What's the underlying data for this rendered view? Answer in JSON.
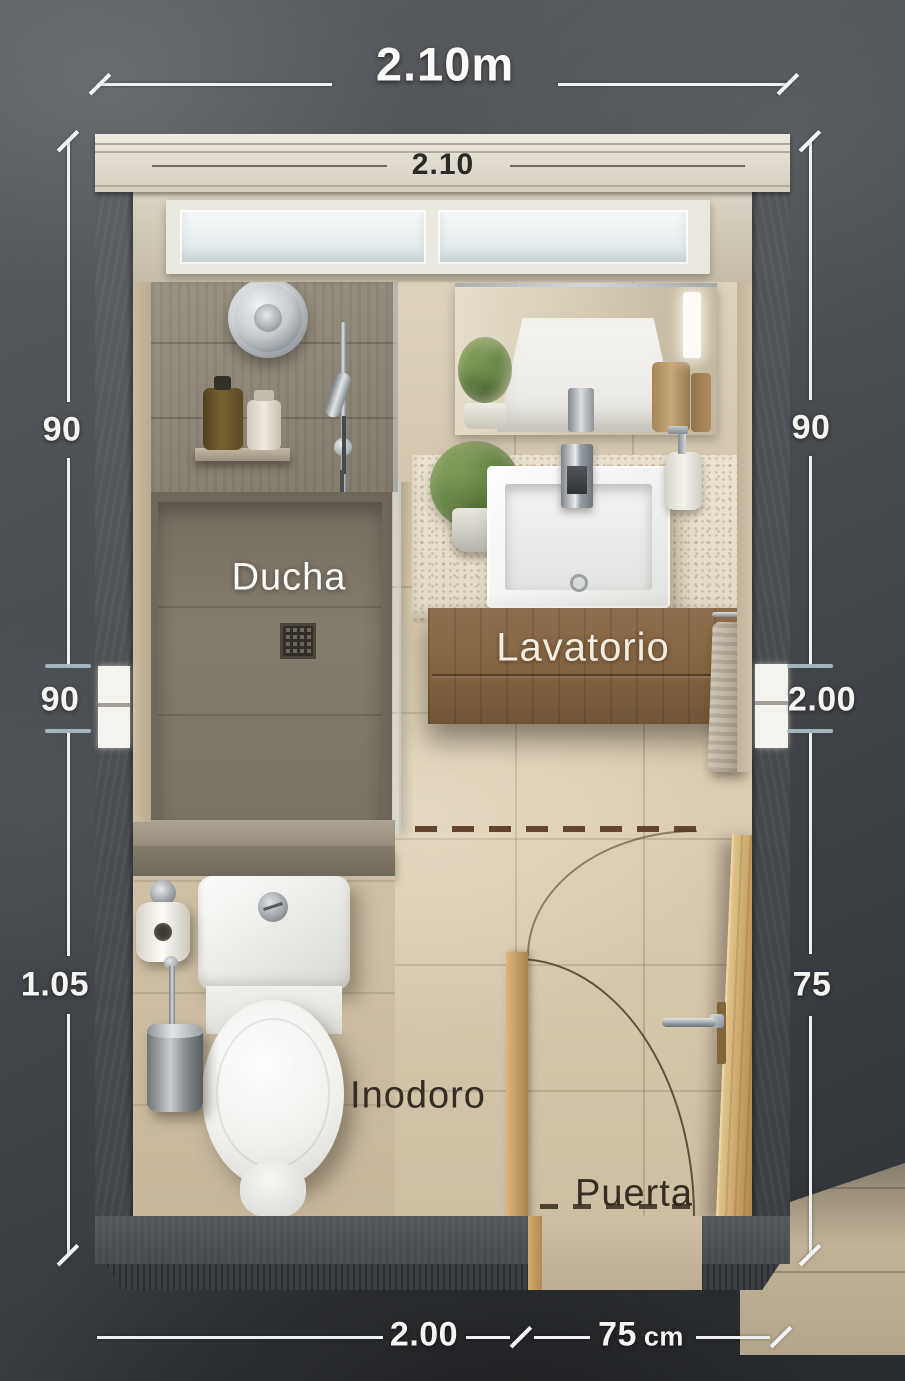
{
  "meta": {
    "type": "bathroom-floor-plan",
    "view": "3d-top-down-render"
  },
  "dimensions": {
    "top_outer": "2.10m",
    "top_inner": "2.10",
    "left_upper": "90",
    "left_middle": "90",
    "left_lower": "1.05",
    "right_upper": "90",
    "right_middle": "2.00",
    "right_lower": "75",
    "bottom_inner": "2.00",
    "bottom_door_value": "75",
    "bottom_door_unit": "cm"
  },
  "labels": {
    "shower": "Ducha",
    "vanity": "Lavatorio",
    "toilet": "Inodoro",
    "door": "Puerta"
  },
  "colors": {
    "background_dark": "#3a3d41",
    "wall_gray": "#515458",
    "wall_band_cream": "#e6e1d5",
    "floor_beige": "#d0c2a9",
    "shower_tile": "#948c7e",
    "wood_vanity": "#81643f",
    "wood_door": "#c59e63",
    "fixture_white": "#f2f2f0",
    "chrome": "#b9bfc3",
    "dimension_text": "#f4f4f2",
    "dark_label": "#342d24",
    "opening_tick": "#a9bac3",
    "door_swing_dashed": "#5b3d28"
  }
}
